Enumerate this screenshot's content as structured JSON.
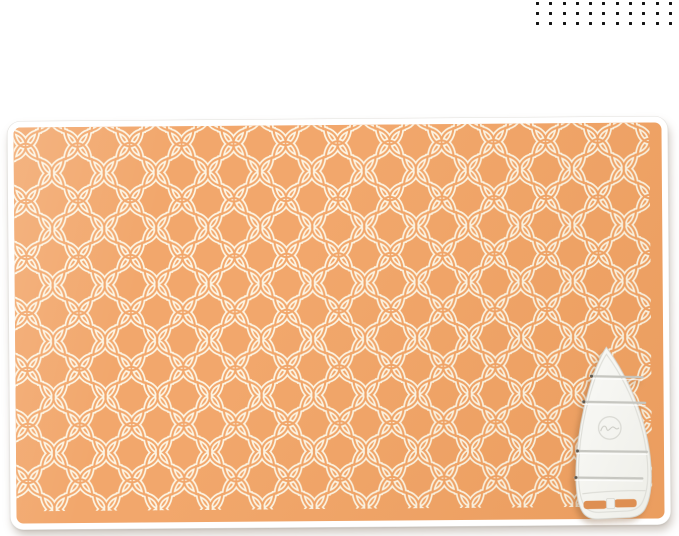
{
  "page": {
    "background_color": "#ffffff",
    "content": "product photo of an orange quilted ironing blanket with a white silicone iron rest pad"
  },
  "decoration": {
    "dot_grid": {
      "rows": 3,
      "cols": 11,
      "dot_size": 3,
      "gap_x": 13.3,
      "gap_y": 10,
      "color": "#141414"
    }
  },
  "product": {
    "blanket": {
      "base_color": "#f1a263",
      "pattern": "quatrefoil-trellis",
      "pattern_line_color": "#fcf4e2",
      "trim_color": "#ffffff"
    },
    "iron_rest": {
      "body_color": "#fafaf7",
      "body_shade_color": "#eeeee8",
      "outline_color": "#d6d6d0",
      "inner_line_color": "#dedeD8",
      "groove_color": "#c6c6c0",
      "groove_pin_color": "#5e584f",
      "groove_count": 4,
      "logo": "embossed-script-logo",
      "slot_color": "#de8f52"
    }
  }
}
